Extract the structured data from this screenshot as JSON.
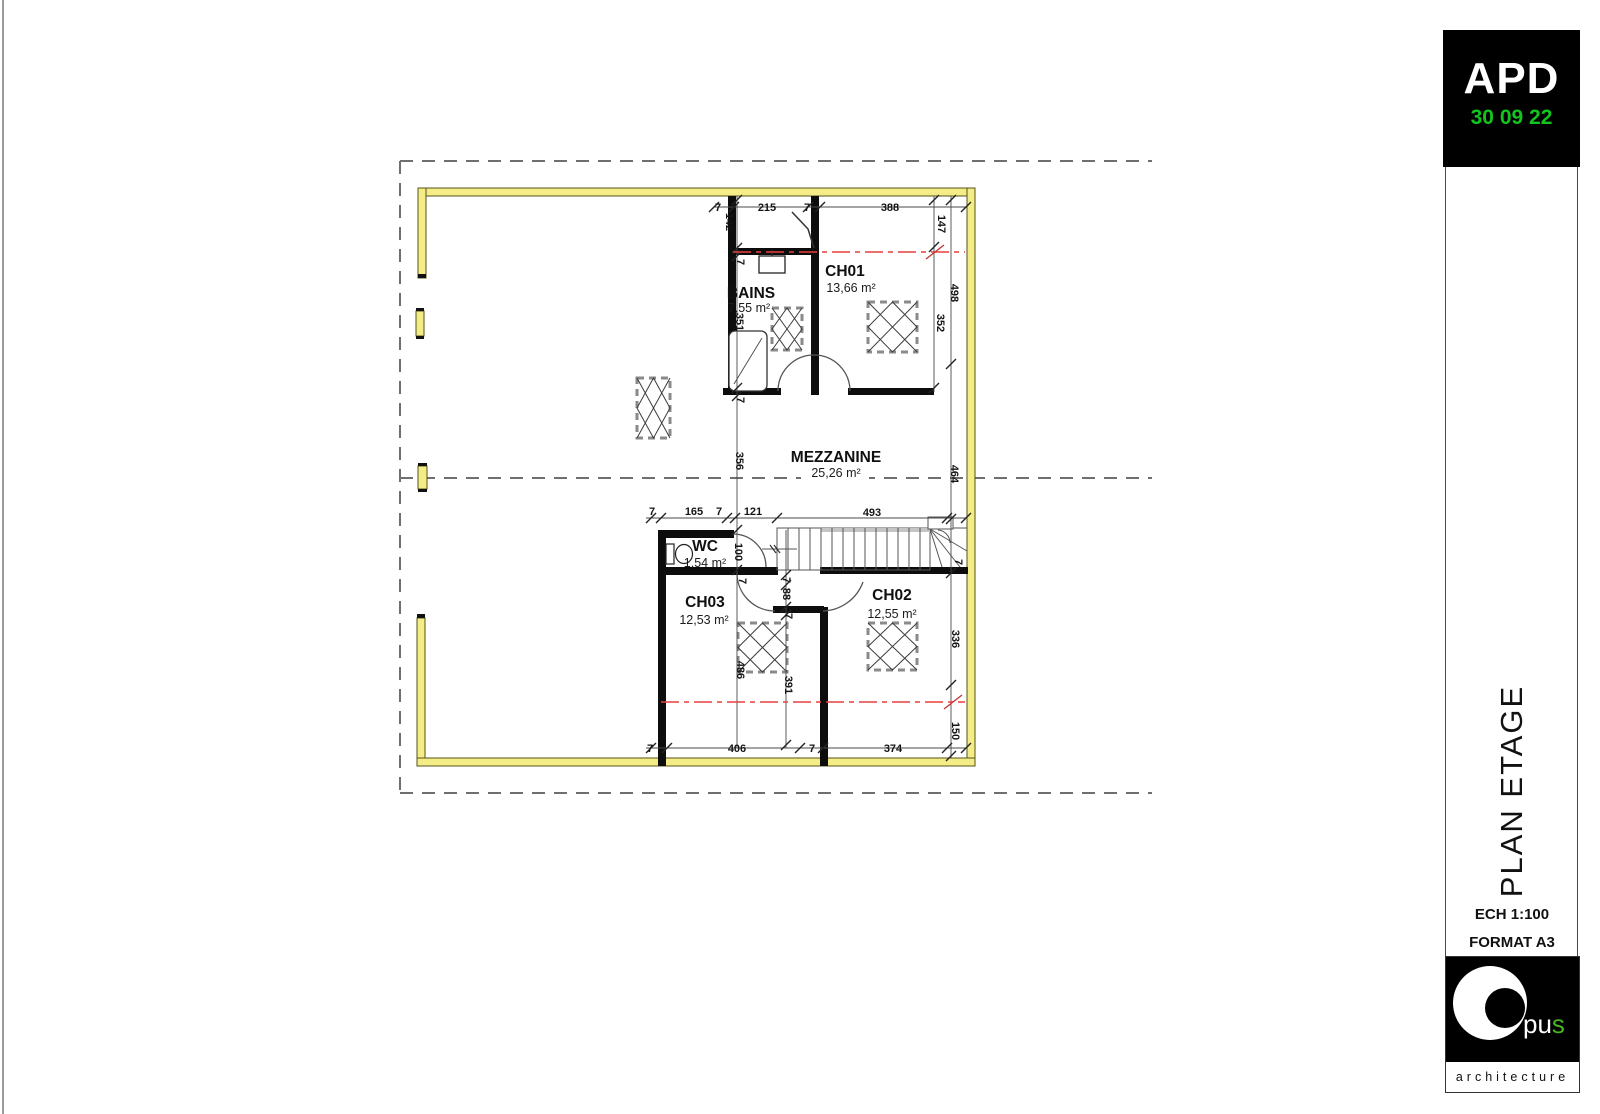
{
  "title_block": {
    "phase": "APD",
    "date": "30 09 22",
    "drawing_title": "PLAN ETAGE",
    "scale": "ECH 1:100",
    "format": "FORMAT A3",
    "logo": {
      "prefix": "pu",
      "green_letter": "s",
      "tagline": "architecture"
    },
    "colors": {
      "date_green": "#12c41e",
      "logo_green": "#46b71e"
    }
  },
  "plan": {
    "colors": {
      "exterior_wall_yellow": "#f4ec86",
      "interior_wall_black": "#0d0d0d",
      "axis_red": "#e8403f",
      "boundary_gray": "#6f6f6f"
    },
    "rooms": [
      {
        "name": "BAINS",
        "area": "7,55 m²",
        "nx": 751,
        "ny": 298,
        "ax": 749,
        "ay": 312
      },
      {
        "name": "CH01",
        "area": "13,66 m²",
        "nx": 845,
        "ny": 276,
        "ax": 851,
        "ay": 292
      },
      {
        "name": "MEZZANINE",
        "area": "25,26 m²",
        "nx": 836,
        "ny": 462,
        "ax": 836,
        "ay": 477
      },
      {
        "name": "WC",
        "area": "1,54 m²",
        "nx": 705,
        "ny": 551,
        "ax": 705,
        "ay": 567
      },
      {
        "name": "CH03",
        "area": "12,53 m²",
        "nx": 705,
        "ny": 607,
        "ax": 704,
        "ay": 624
      },
      {
        "name": "CH02",
        "area": "12,55 m²",
        "nx": 892,
        "ny": 600,
        "ax": 892,
        "ay": 618
      }
    ],
    "dim_labels": [
      {
        "t": "7",
        "x": 718,
        "y": 211,
        "r": 0
      },
      {
        "t": "215",
        "x": 767,
        "y": 211,
        "r": 0
      },
      {
        "t": "7",
        "x": 807,
        "y": 211,
        "r": 0
      },
      {
        "t": "388",
        "x": 890,
        "y": 211,
        "r": 0
      },
      {
        "t": "7",
        "x": 652,
        "y": 515,
        "r": 0
      },
      {
        "t": "165",
        "x": 694,
        "y": 515,
        "r": 0
      },
      {
        "t": "7",
        "x": 719,
        "y": 515,
        "r": 0
      },
      {
        "t": "121",
        "x": 753,
        "y": 515,
        "r": 0
      },
      {
        "t": "493",
        "x": 872,
        "y": 516,
        "r": 0
      },
      {
        "t": "7",
        "x": 650,
        "y": 752,
        "r": 0
      },
      {
        "t": "406",
        "x": 737,
        "y": 752,
        "r": 0
      },
      {
        "t": "7",
        "x": 812,
        "y": 752,
        "r": 0
      },
      {
        "t": "374",
        "x": 893,
        "y": 752,
        "r": 0
      },
      {
        "t": "142",
        "x": 726,
        "y": 222,
        "r": 90
      },
      {
        "t": "7",
        "x": 737,
        "y": 262,
        "r": 90
      },
      {
        "t": "351",
        "x": 736,
        "y": 322,
        "r": 90
      },
      {
        "t": "7",
        "x": 737,
        "y": 400,
        "r": 90
      },
      {
        "t": "356",
        "x": 736,
        "y": 461,
        "r": 90
      },
      {
        "t": "100",
        "x": 735,
        "y": 552,
        "r": 90
      },
      {
        "t": "7",
        "x": 739,
        "y": 581,
        "r": 90
      },
      {
        "t": "7",
        "x": 783,
        "y": 580,
        "r": 90
      },
      {
        "t": "88",
        "x": 783,
        "y": 594,
        "r": 90
      },
      {
        "t": "7",
        "x": 785,
        "y": 616,
        "r": 90
      },
      {
        "t": "486",
        "x": 737,
        "y": 670,
        "r": 90
      },
      {
        "t": "391",
        "x": 785,
        "y": 685,
        "r": 90
      },
      {
        "t": "147",
        "x": 938,
        "y": 224,
        "r": 90
      },
      {
        "t": "498",
        "x": 951,
        "y": 293,
        "r": 90
      },
      {
        "t": "352",
        "x": 937,
        "y": 323,
        "r": 90
      },
      {
        "t": "464",
        "x": 951,
        "y": 474,
        "r": 90
      },
      {
        "t": "336",
        "x": 952,
        "y": 639,
        "r": 90
      },
      {
        "t": "150",
        "x": 952,
        "y": 731,
        "r": 90
      },
      {
        "t": "7",
        "x": 955,
        "y": 562,
        "r": 90
      }
    ]
  }
}
